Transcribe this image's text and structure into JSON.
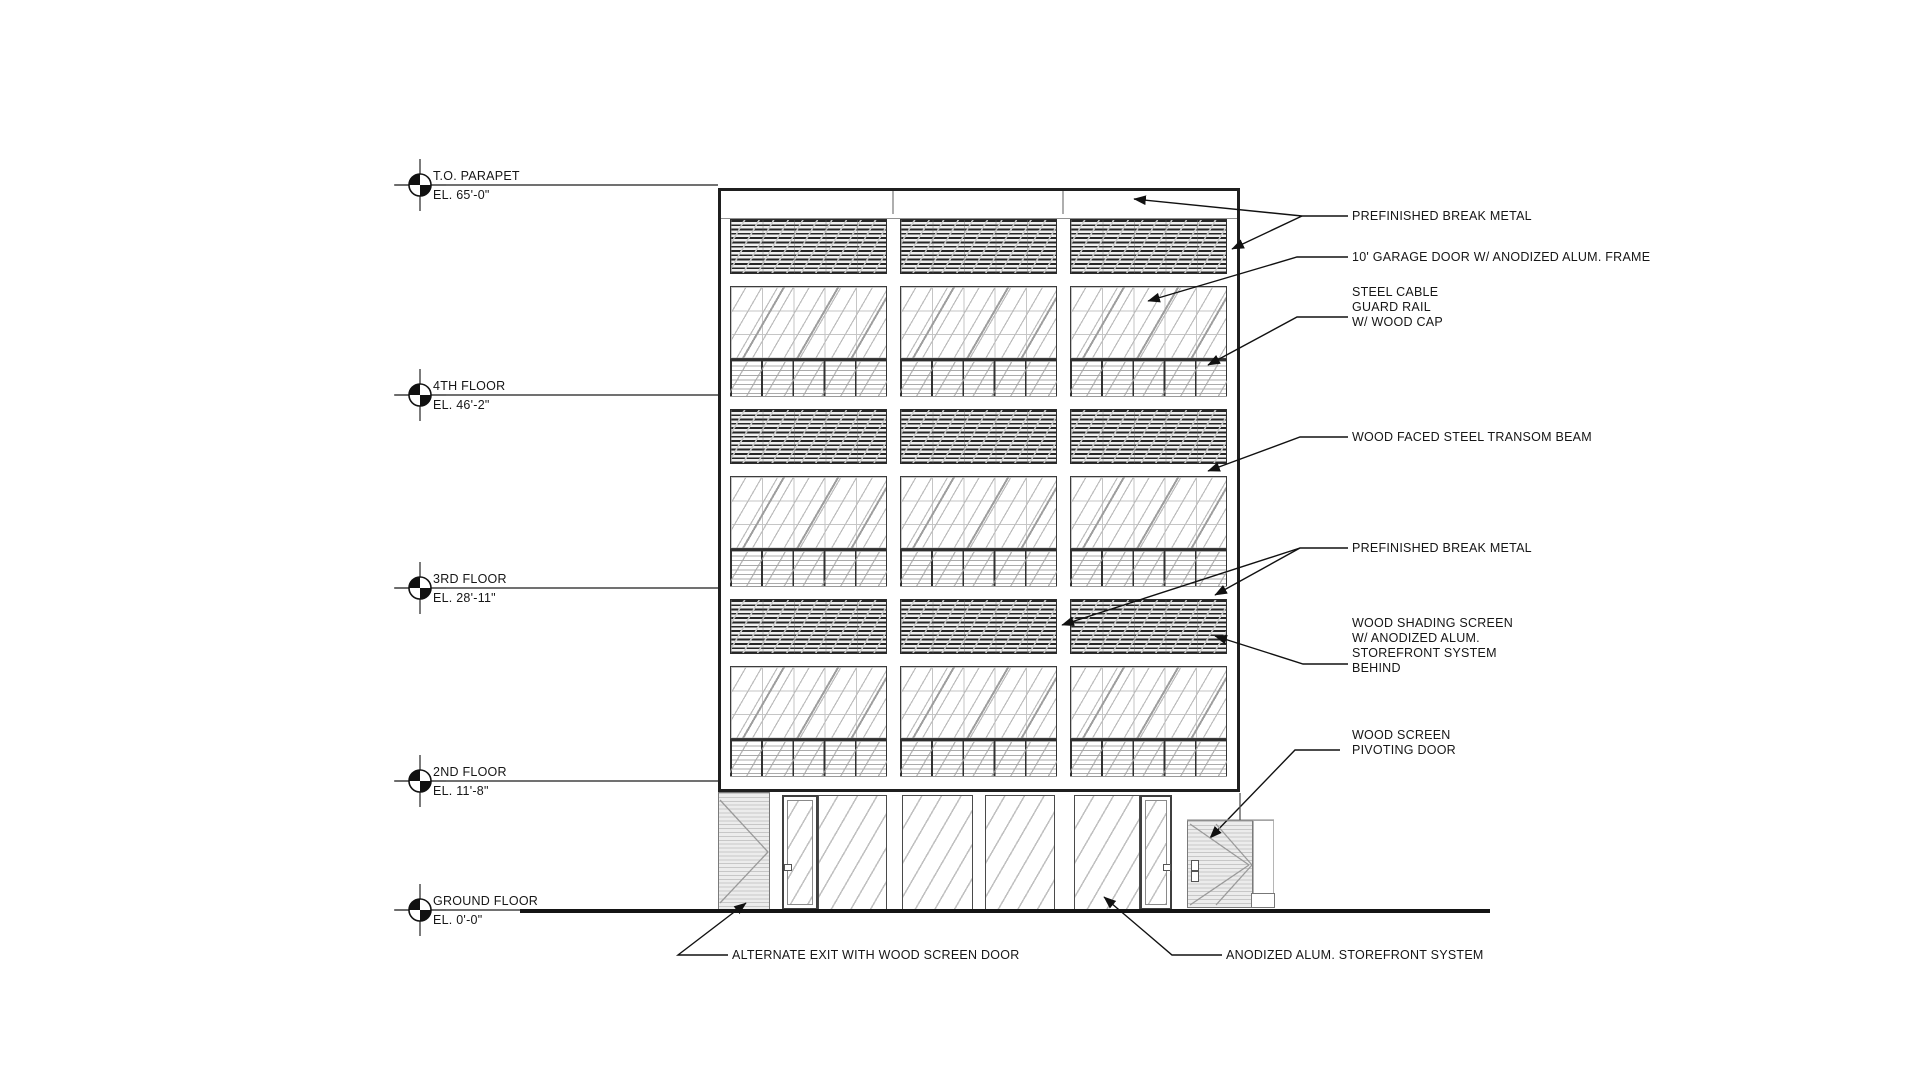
{
  "title": "BUILDING ELEVATION",
  "colors": {
    "ink": "#111111",
    "light_line": "#9a9a9a",
    "paper": "#ffffff"
  },
  "markers": [
    {
      "name": "T.O. PARAPET",
      "el": "EL. 65'-0\""
    },
    {
      "name": "4TH FLOOR",
      "el": "EL. 46'-2\""
    },
    {
      "name": "3RD FLOOR",
      "el": "EL. 28'-11\""
    },
    {
      "name": "2ND FLOOR",
      "el": "EL. 11'-8\""
    },
    {
      "name": "GROUND FLOOR",
      "el": "EL. 0'-0\""
    }
  ],
  "callouts": {
    "break_metal_top": "PREFINISHED BREAK METAL",
    "garage_door": "10' GARAGE DOOR W/ ANODIZED ALUM. FRAME",
    "guard_rail": "STEEL CABLE\nGUARD RAIL\nW/ WOOD CAP",
    "transom_beam": "WOOD FACED STEEL TRANSOM BEAM",
    "break_metal_mid": "PREFINISHED BREAK METAL",
    "shading_screen": "WOOD  SHADING SCREEN\nW/ ANODIZED ALUM.\nSTOREFRONT SYSTEM\nBEHIND",
    "pivot_door": "WOOD SCREEN\nPIVOTING  DOOR",
    "alt_exit": "ALTERNATE EXIT WITH WOOD SCREEN DOOR",
    "storefront": "ANODIZED ALUM. STOREFRONT SYSTEM"
  }
}
